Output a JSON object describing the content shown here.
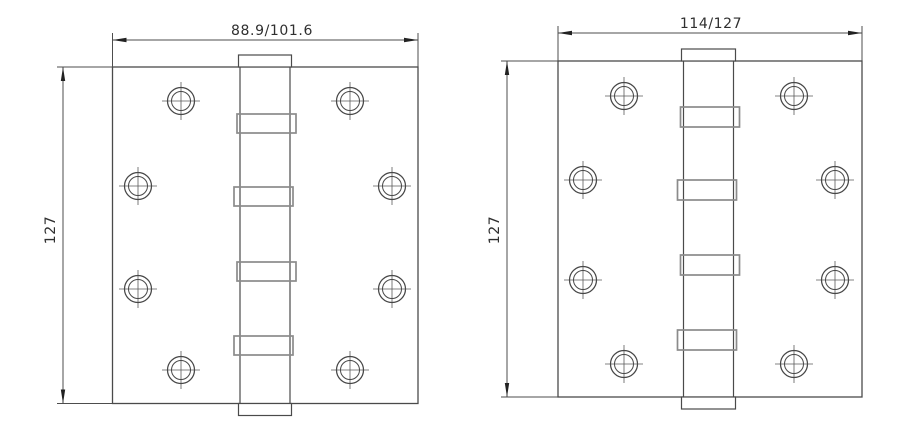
{
  "window": {
    "background_color": "#ffffff",
    "description": "Technical dimension drawing of two ball-bearing door hinges, front views"
  },
  "diagram": {
    "type": "technical-drawing",
    "line_color": "#4a4a4a",
    "light_line_color": "#8b8b8b",
    "views": [
      {
        "id": "hinge-left",
        "width_dimension": "88.9/101.6",
        "height_dimension": "127"
      },
      {
        "id": "hinge-right",
        "width_dimension": "114/127",
        "height_dimension": "127"
      }
    ]
  }
}
